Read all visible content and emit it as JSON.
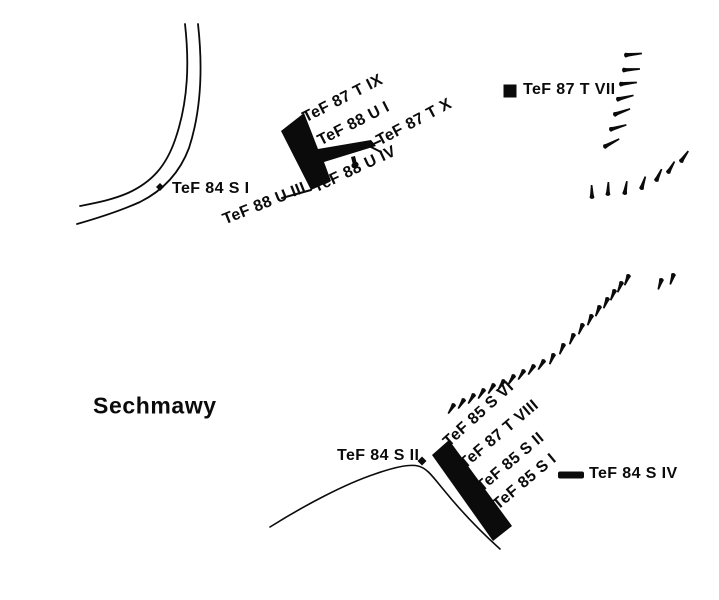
{
  "figure": {
    "width": 719,
    "height": 600,
    "background": "#ffffff",
    "ink": "#0b0b0b",
    "description": "Archaeological excavation sketch map of Sechmawy with trench locations (TeF seasons 84-88)"
  },
  "map": {
    "ink": "#0b0b0b",
    "labels": [
      {
        "id": "tef87-t-ix",
        "text": "TeF 87 T IX",
        "x": 308,
        "y": 127,
        "rot": -27,
        "size": 16
      },
      {
        "id": "tef88-u-i",
        "text": "TeF 88 U I",
        "x": 323,
        "y": 150,
        "rot": -27,
        "size": 16
      },
      {
        "id": "tef87-t-x",
        "text": "TeF 87 T X",
        "x": 382,
        "y": 150,
        "rot": -28,
        "size": 16
      },
      {
        "id": "tef88-u-iv",
        "text": "TeF 88 U IV",
        "x": 318,
        "y": 197,
        "rot": -25,
        "size": 16
      },
      {
        "id": "tef88-u-iii",
        "text": "TeF 88 U III",
        "x": 227,
        "y": 229,
        "rot": -22,
        "size": 16
      },
      {
        "id": "tef84-s-i",
        "text": "TeF 84 S I",
        "x": 172,
        "y": 198,
        "rot": 0,
        "size": 16
      },
      {
        "id": "tef87-t-vii",
        "text": "TeF 87 T VII",
        "x": 523,
        "y": 99,
        "rot": 0,
        "size": 16
      },
      {
        "id": "tef85-s-vi",
        "text": "TeF 85 S VI",
        "x": 452,
        "y": 451,
        "rot": -42,
        "size": 16
      },
      {
        "id": "tef87-t-viii",
        "text": "TeF 87 T VIII",
        "x": 468,
        "y": 473,
        "rot": -40,
        "size": 16
      },
      {
        "id": "tef85-s-ii",
        "text": "TeF 85 S II",
        "x": 485,
        "y": 496,
        "rot": -40,
        "size": 16
      },
      {
        "id": "tef85-s-i",
        "text": "TeF 85 S I",
        "x": 501,
        "y": 514,
        "rot": -40,
        "size": 16
      },
      {
        "id": "tef84-s-ii",
        "text": "TeF 84 S II",
        "x": 337,
        "y": 465,
        "rot": 0,
        "size": 16
      },
      {
        "id": "tef84-s-iv",
        "text": "TeF 84 S IV",
        "x": 589,
        "y": 483,
        "rot": 0,
        "size": 16
      },
      {
        "id": "sechmawy",
        "text": "Sechmawy",
        "x": 93,
        "y": 419,
        "rot": 0,
        "size": 23,
        "cls": "town"
      }
    ],
    "roads": [
      {
        "id": "canal-inner-line",
        "d": "M 185,24 C 189,60 189,100 175,140 C 166,166 152,182 128,193 C 112,200 95,203 80,206",
        "w": 1.8
      },
      {
        "id": "canal-outer-line",
        "d": "M 198,24 C 202,60 203,105 189,148 C 180,172 164,190 140,202 C 120,211 98,218 77,224",
        "w": 1.8
      },
      {
        "id": "south-contour-line",
        "d": "M 270,527 C 305,505 345,484 375,474 C 395,467 410,464 418,466 C 427,468 433,477 443,489 C 460,510 480,531 500,549",
        "w": 1.6
      }
    ],
    "trenches": [
      {
        "id": "trench-central-L",
        "points": "281,131 304,113 318,149 371,140 376,146 324,162 331,181 311,190"
      },
      {
        "id": "trench-central-tick",
        "points": "351,157 355,156 358,168 354,169"
      },
      {
        "id": "trench-south-bar",
        "points": "432,455 449,440 512,526 493,541"
      }
    ],
    "leaders": [
      {
        "id": "leader-u-iii",
        "d": "M 282,198 L 311,190",
        "w": 2
      },
      {
        "id": "leader-t-x-arrow",
        "d": "M 380,141 L 369,146 L 381,152",
        "w": 2
      }
    ],
    "markers": [
      {
        "id": "marker-tef84-s-i",
        "type": "diamond",
        "x": 160,
        "y": 187,
        "s": 8
      },
      {
        "id": "marker-tef87-t-vii",
        "type": "square",
        "x": 510,
        "y": 91,
        "s": 13
      },
      {
        "id": "marker-tef84-s-ii",
        "type": "diamond",
        "x": 422,
        "y": 461,
        "s": 9
      },
      {
        "id": "marker-tef84-s-iv",
        "type": "dash",
        "x": 571,
        "y": 475,
        "wd": 26,
        "ht": 7
      }
    ],
    "hachure_groups": [
      {
        "id": "north-mound-edge-column",
        "len": 15,
        "marks": [
          [
            627,
            55,
            -6
          ],
          [
            625,
            70,
            -4
          ],
          [
            622,
            84,
            -6
          ],
          [
            619,
            99,
            -14
          ],
          [
            616,
            114,
            -20
          ],
          [
            612,
            129,
            -16
          ],
          [
            606,
            146,
            -28
          ]
        ]
      },
      {
        "id": "north-mound-edge-arc",
        "len": 11,
        "marks": [
          [
            592,
            196,
            268
          ],
          [
            608,
            193,
            272
          ],
          [
            625,
            192,
            280
          ],
          [
            642,
            187,
            288
          ],
          [
            657,
            179,
            295
          ],
          [
            669,
            171,
            300
          ],
          [
            682,
            160,
            305
          ]
        ]
      },
      {
        "id": "south-mound-edge-lower",
        "len": 9,
        "marks": [
          [
            453,
            406,
            122
          ],
          [
            463,
            401,
            122
          ],
          [
            473,
            396,
            122
          ],
          [
            483,
            391,
            122
          ],
          [
            493,
            386,
            122
          ],
          [
            503,
            382,
            122
          ],
          [
            513,
            377,
            122
          ],
          [
            523,
            372,
            122
          ],
          [
            533,
            367,
            122
          ],
          [
            543,
            362,
            122
          ]
        ]
      },
      {
        "id": "south-mound-edge-upper",
        "len": 9,
        "marks": [
          [
            553,
            356,
            112
          ],
          [
            563,
            346,
            112
          ],
          [
            573,
            336,
            112
          ],
          [
            582,
            326,
            112
          ],
          [
            591,
            317,
            112
          ],
          [
            599,
            308,
            112
          ],
          [
            607,
            300,
            112
          ],
          [
            614,
            292,
            112
          ],
          [
            621,
            284,
            112
          ],
          [
            628,
            277,
            112
          ]
        ]
      },
      {
        "id": "south-mound-edge-outliers",
        "len": 9,
        "marks": [
          [
            661,
            281,
            108
          ],
          [
            673,
            276,
            108
          ]
        ]
      }
    ]
  }
}
